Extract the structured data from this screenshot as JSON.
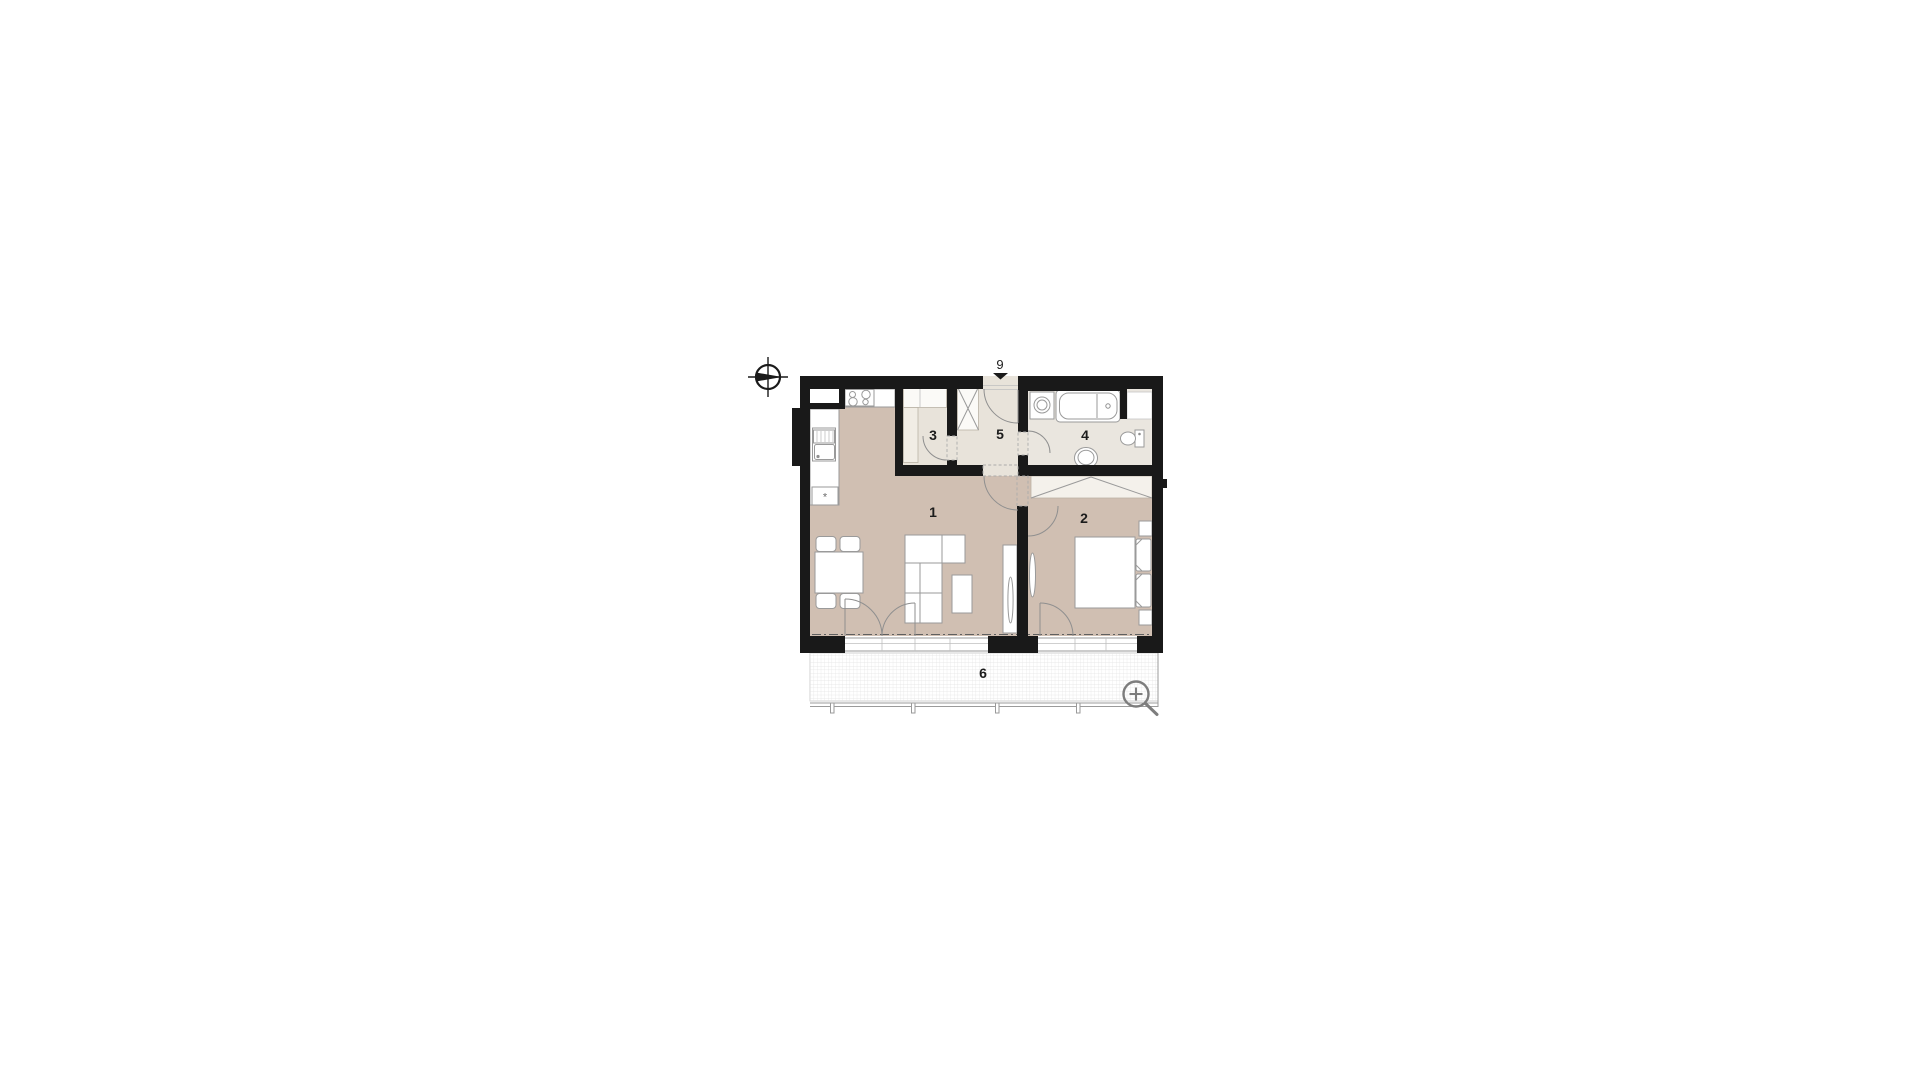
{
  "floorplan": {
    "room_labels": {
      "living": "1",
      "bedroom": "2",
      "closet": "3",
      "bathroom": "4",
      "hall": "5",
      "balcony": "6"
    },
    "entrance_label": "9",
    "appliance_symbol": "*",
    "colors": {
      "wall": "#191919",
      "floor": "#d0bfb2",
      "cream": "#e8e3da",
      "bath": "#eae6df",
      "wardrobe": "#f4f1eb",
      "line": "#9a9a9a"
    },
    "icons": {
      "compass": "north-compass-icon",
      "magnifier": "zoom-in-icon",
      "entrance_arrow": "entrance-arrow-icon"
    }
  }
}
